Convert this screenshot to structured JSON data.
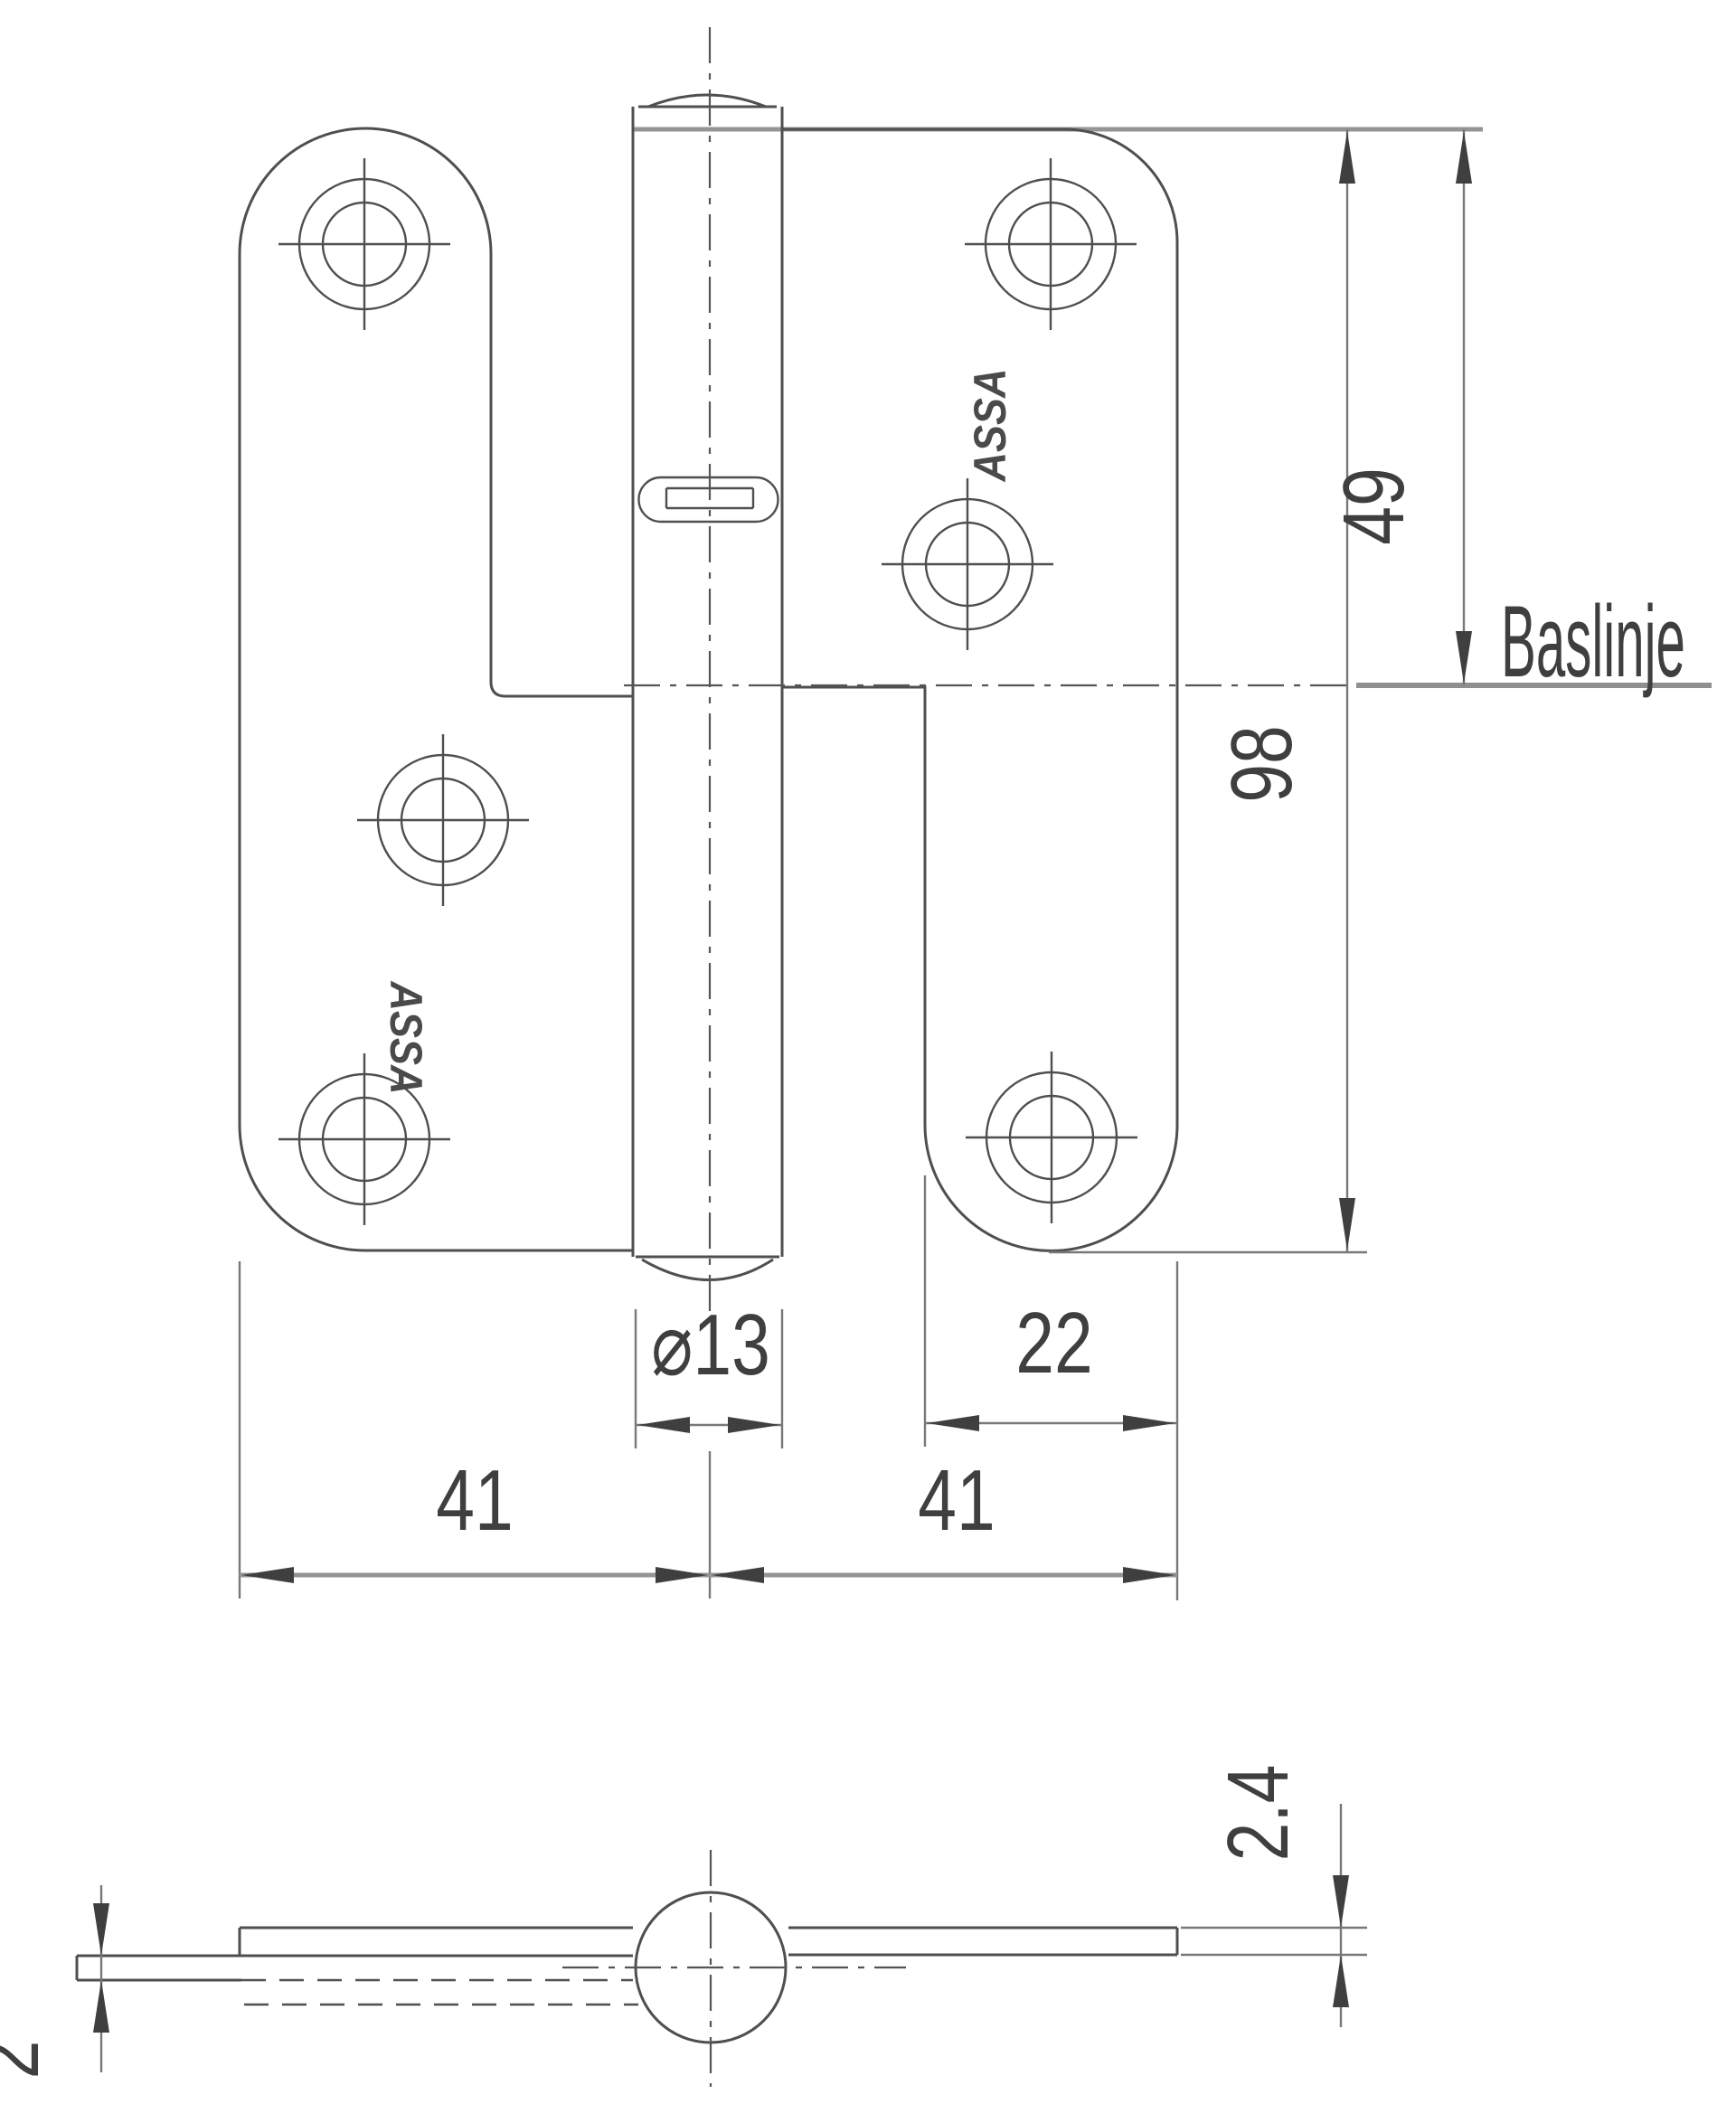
{
  "front_view": {
    "dim_to_baseline": "49",
    "dim_total_height": "98",
    "dim_left_leaf_width": "41",
    "dim_right_leaf_width": "41",
    "dim_leaf_plate_width": "22",
    "dim_pin_diameter": "⌀13",
    "baseline_label": "Baslinje",
    "brand_left": "ASSA",
    "brand_right": "ASSA"
  },
  "side_view": {
    "dim_left_leaf_thickness": "2",
    "dim_right_leaf_thickness": "2.4"
  }
}
